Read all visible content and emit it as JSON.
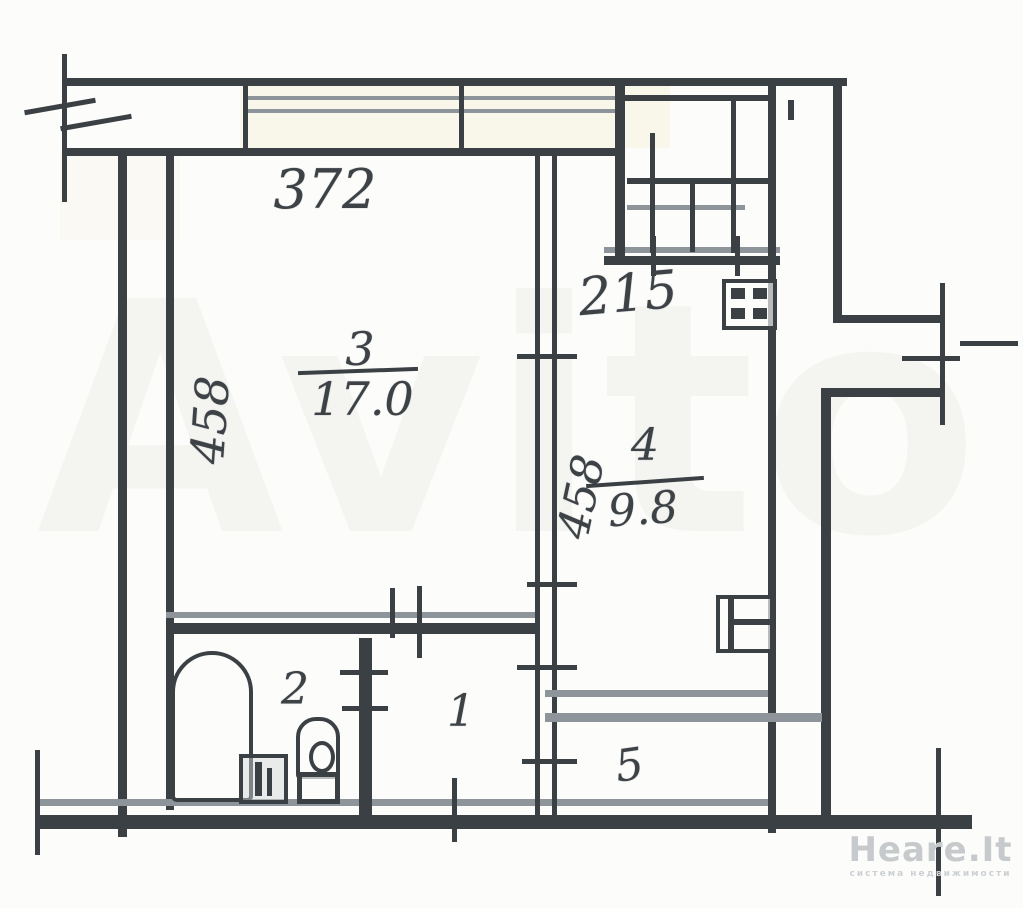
{
  "plan": {
    "dim_top": "372",
    "dim_left_vertical": "458",
    "dim_mid_vertical": "458",
    "dim_kitchen": "215",
    "rooms": {
      "living": {
        "number": "3",
        "area": "17.0"
      },
      "kitchen": {
        "number": "4",
        "area": "9.8"
      },
      "bathroom": {
        "number": "2"
      },
      "hall": {
        "number": "1"
      },
      "balcony": {
        "number": "5"
      }
    }
  },
  "watermark": {
    "brand": "Avito"
  },
  "logo": {
    "name": "Heare.It",
    "tagline": "система недвижимости"
  },
  "colors": {
    "line_dark": "#3b4045",
    "line_medium": "#8d959a",
    "paper": "#fcfcfa",
    "logo_gray": "#c6cacc"
  }
}
